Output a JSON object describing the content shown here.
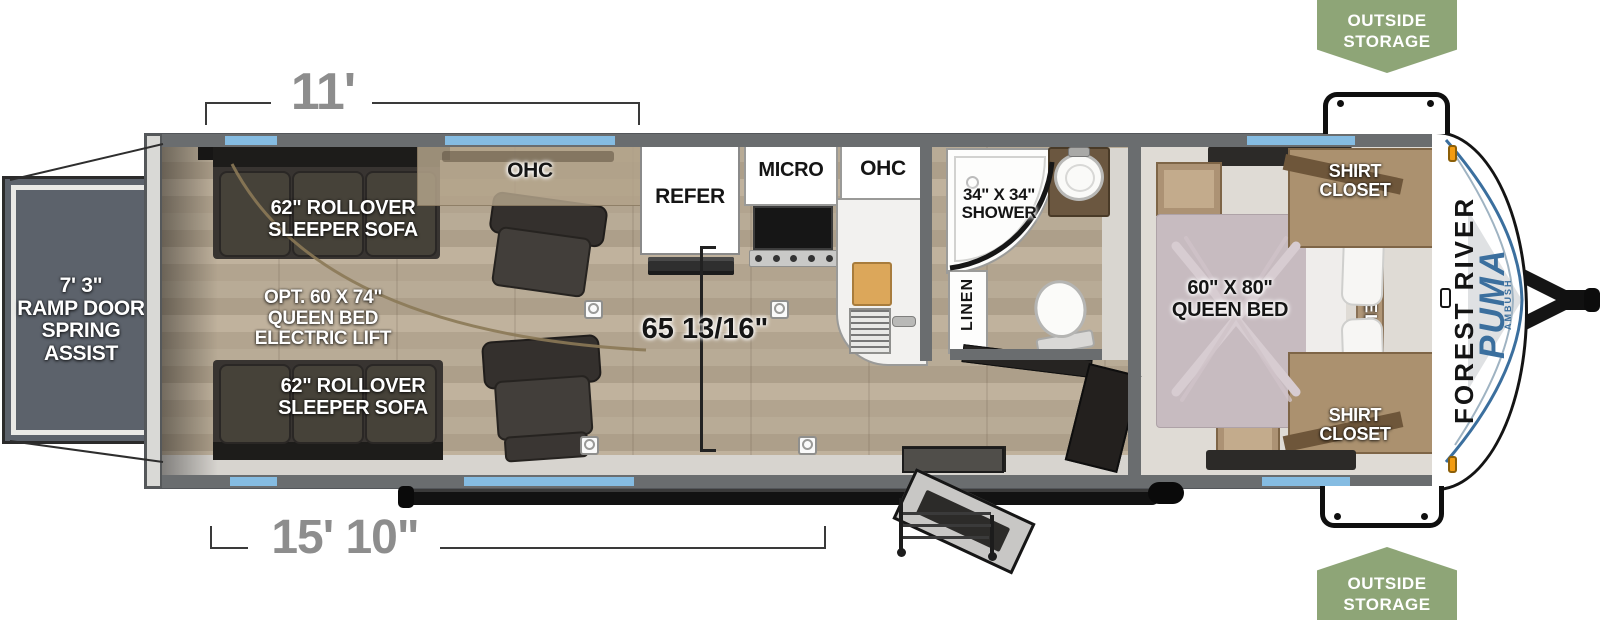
{
  "colors": {
    "window_blue": "#85bce2",
    "wall_gray": "#6a6d6f",
    "badge_green": "#8ea577",
    "brand_blue": "#3b6f9e",
    "floor_wood": "#b5a893"
  },
  "badges": {
    "top": {
      "line1": "OUTSIDE",
      "line2": "STORAGE"
    },
    "bottom": {
      "line1": "OUTSIDE",
      "line2": "STORAGE"
    }
  },
  "dimensions": {
    "garage_length": "11'",
    "main_length": "15' 10\"",
    "interior_width": "65 13/16\""
  },
  "ramp": {
    "l1": "7' 3\"",
    "l2": "RAMP DOOR",
    "l3": "SPRING",
    "l4": "ASSIST"
  },
  "garage": {
    "sofa_top": {
      "l1": "62\" ROLLOVER",
      "l2": "SLEEPER SOFA"
    },
    "opt_bed": {
      "l1": "OPT. 60 X 74\"",
      "l2": "QUEEN BED",
      "l3": "ELECTRIC LIFT"
    },
    "sofa_bottom": {
      "l1": "62\" ROLLOVER",
      "l2": "SLEEPER SOFA"
    },
    "ohc": "OHC"
  },
  "kitchen": {
    "refer": "REFER",
    "micro": "MICRO",
    "ohc": "OHC"
  },
  "bathroom": {
    "shower": {
      "l1": "34\" X 34\"",
      "l2": "SHOWER"
    },
    "linen": "LINEN"
  },
  "bedroom": {
    "bed": {
      "l1": "60\" X 80\"",
      "l2": "QUEEN BED"
    },
    "shirt_closet": {
      "l1": "SHIRT",
      "l2": "CLOSET"
    },
    "shelf": "SHELF"
  },
  "brand": {
    "maker": "FOREST RIVER",
    "model": "PUMA",
    "trim": "AMBUSH"
  }
}
